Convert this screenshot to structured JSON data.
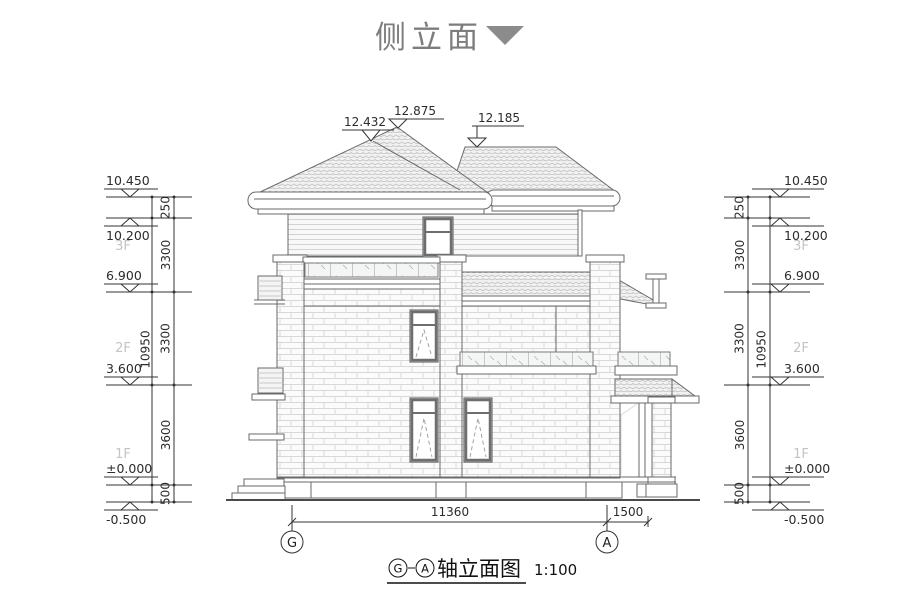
{
  "title": {
    "text": "侧立面"
  },
  "roof_marks": [
    {
      "label": "12.432"
    },
    {
      "label": "12.875"
    },
    {
      "label": "12.185"
    }
  ],
  "levels": [
    {
      "label": "10.450"
    },
    {
      "label": "10.200"
    },
    {
      "label": "6.900"
    },
    {
      "label": "3.600"
    },
    {
      "label": "±0.000"
    },
    {
      "label": "-0.500"
    }
  ],
  "floors": [
    {
      "label": "3F"
    },
    {
      "label": "2F"
    },
    {
      "label": "1F"
    }
  ],
  "segments": [
    {
      "label": "250"
    },
    {
      "label": "3300"
    },
    {
      "label": "3300"
    },
    {
      "label": "3600"
    },
    {
      "label": "500"
    }
  ],
  "overall": {
    "label": "10950"
  },
  "bottom": {
    "span": "11360",
    "extension": "1500"
  },
  "axes": [
    {
      "label": "G"
    },
    {
      "label": "A"
    }
  ],
  "caption": {
    "text": "轴立面图",
    "scale": "1:100"
  },
  "colors": {
    "line": "#666666",
    "dim": "#333333",
    "floor_label": "#c4c4c4",
    "title": "#7d7d7d"
  }
}
